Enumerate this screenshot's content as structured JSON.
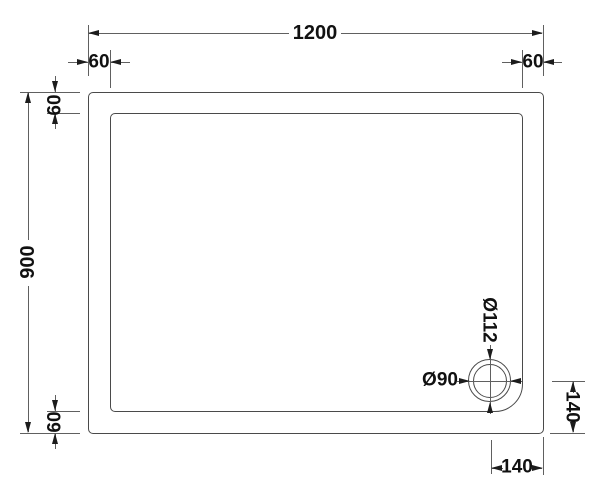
{
  "page": {
    "background": "#ffffff"
  },
  "drawing": {
    "description": "Plan-view technical drawing of a rectangular shower tray with rim and corner waste drain",
    "dims": {
      "overall_width": "1200",
      "overall_height": "900",
      "rim_top_left": "60",
      "rim_top_right": "60",
      "rim_left_top": "60",
      "rim_left_bottom": "60",
      "drain_outer_dia": "Ø112",
      "drain_inner_dia": "Ø90",
      "drain_from_right_edge": "140",
      "drain_from_bottom_edge": "140"
    },
    "colors": {
      "outline": "#4a4a4a",
      "dim_line": "#606060",
      "arrow": "#1c1c1c",
      "text": "#111111"
    }
  }
}
